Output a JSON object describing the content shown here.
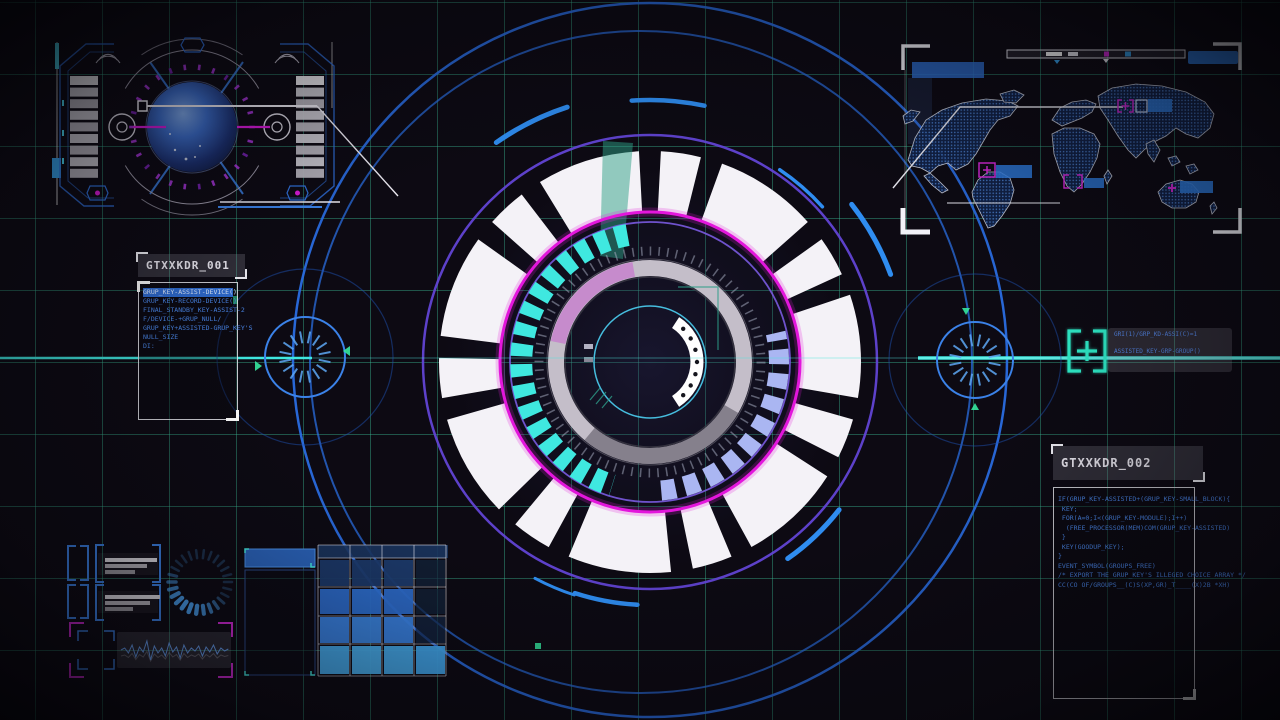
{
  "meta": {
    "title": "Futuristic HUD scanning interface"
  },
  "palette": {
    "background": "#0d0a13",
    "grid_line": "#3abc96",
    "hud_blue": "#2f7fe8",
    "bright_blue": "#49b2f5",
    "navy": "#1c3a6a",
    "violet": "#6244d4",
    "magenta": "#e316dc",
    "cyan": "#3fe8e0",
    "spring_marker": "#2ff0cc",
    "lavender": "#aab6f2",
    "gray_ring": "#c4bec9",
    "teal_beam": "#2e9f86",
    "white": "#f4f2f7",
    "code_text": "#4a86e8"
  },
  "icons": {
    "target_bracket_plus": "[+]",
    "plus_marker": "+",
    "triangle_up": "▲",
    "triangle_down": "▼",
    "triangle_left": "◀",
    "triangle_right": "▶"
  },
  "panels": {
    "left": {
      "title": "GTXXKDR_001",
      "lines": [
        "GRUP_KEY-ASSIST-DEVICE()",
        "GRUP_KEY-RECORD-DEVICE()",
        "FINAL_STANDBY_KEY-ASSIST-2",
        "",
        "F/DEVICE-+GRUP_NULL/",
        "GRUP_KEY+ASSISTED-GRUP_KEY'S",
        "NULL_SIZE",
        "DI:"
      ]
    },
    "right": {
      "title": "GTXXKDR_002",
      "lines": [
        "IF(GRUP_KEY-ASSISTED+(GRUP_KEY-SMALL_BLOCK){",
        " KEY;",
        " FOR(A=0;I<(GRUP_KEY-MODULE);I++)",
        "  (FREE_PROCESSOR(MEM)COM(GRUP_KEY-ASSISTED)",
        " }",
        " KEY(GOODUP_KEY);",
        "}",
        "",
        "EVENT_SYMBOL(GROUPS_FREE)",
        "",
        "/* EXPORT THE GRUP_KEY'S ILLEGED CHOICE ARRAY */",
        "CC(CO OF/GROUPS__(C)S(XP,GR)_T____(X)2B *XH)"
      ]
    },
    "tooltip": {
      "line1": "GRI(1)/GRP_KD-ASSI(C)=1",
      "line2": "ASSISTED_KEY-GRP-GROUP()"
    }
  }
}
